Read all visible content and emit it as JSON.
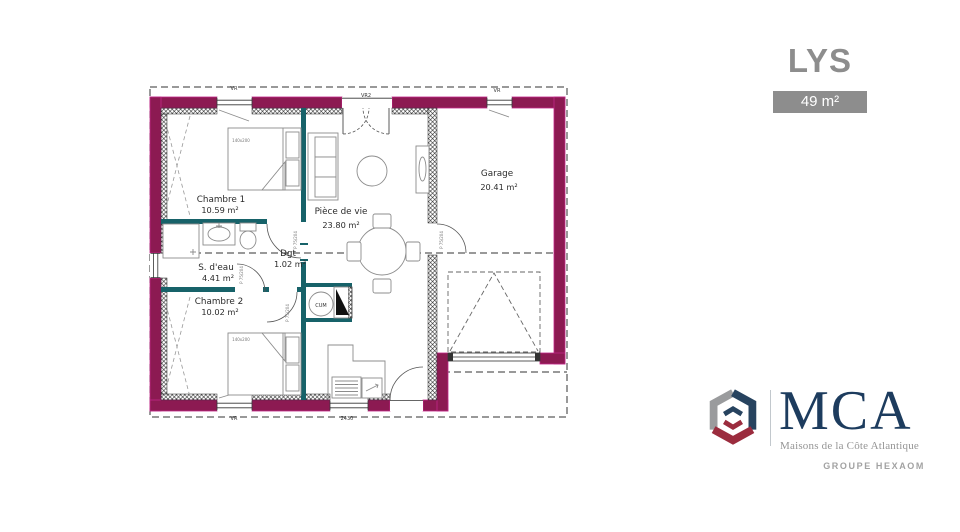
{
  "title": "LYS",
  "area_badge": "49 m²",
  "plan": {
    "rooms": [
      {
        "name": "Chambre 1",
        "area": "10.59 m²"
      },
      {
        "name": "S. d'eau",
        "area": "4.41 m²"
      },
      {
        "name": "Dgt",
        "area": "1.02 m²"
      },
      {
        "name": "Chambre 2",
        "area": "10.02 m²"
      },
      {
        "name": "Pièce de vie",
        "area": "23.80 m²"
      },
      {
        "name": "Garage",
        "area": "20.41 m²"
      }
    ],
    "labels": {
      "roller_shutter": "VR",
      "roller_shutter_2": "VR2",
      "dimension": "2430",
      "small_window": "60",
      "door": "P 75/204",
      "bed": "140x200",
      "water_heater": "CUM"
    },
    "colors": {
      "exterior_wall": "#8c1a52",
      "exterior_wall_edge": "#c12788",
      "interior_wall": "#176269"
    }
  },
  "branding": {
    "name": "MCA",
    "subtitle": "Maisons de la Côte Atlantique",
    "group": "GROUPE HEXAOM"
  }
}
